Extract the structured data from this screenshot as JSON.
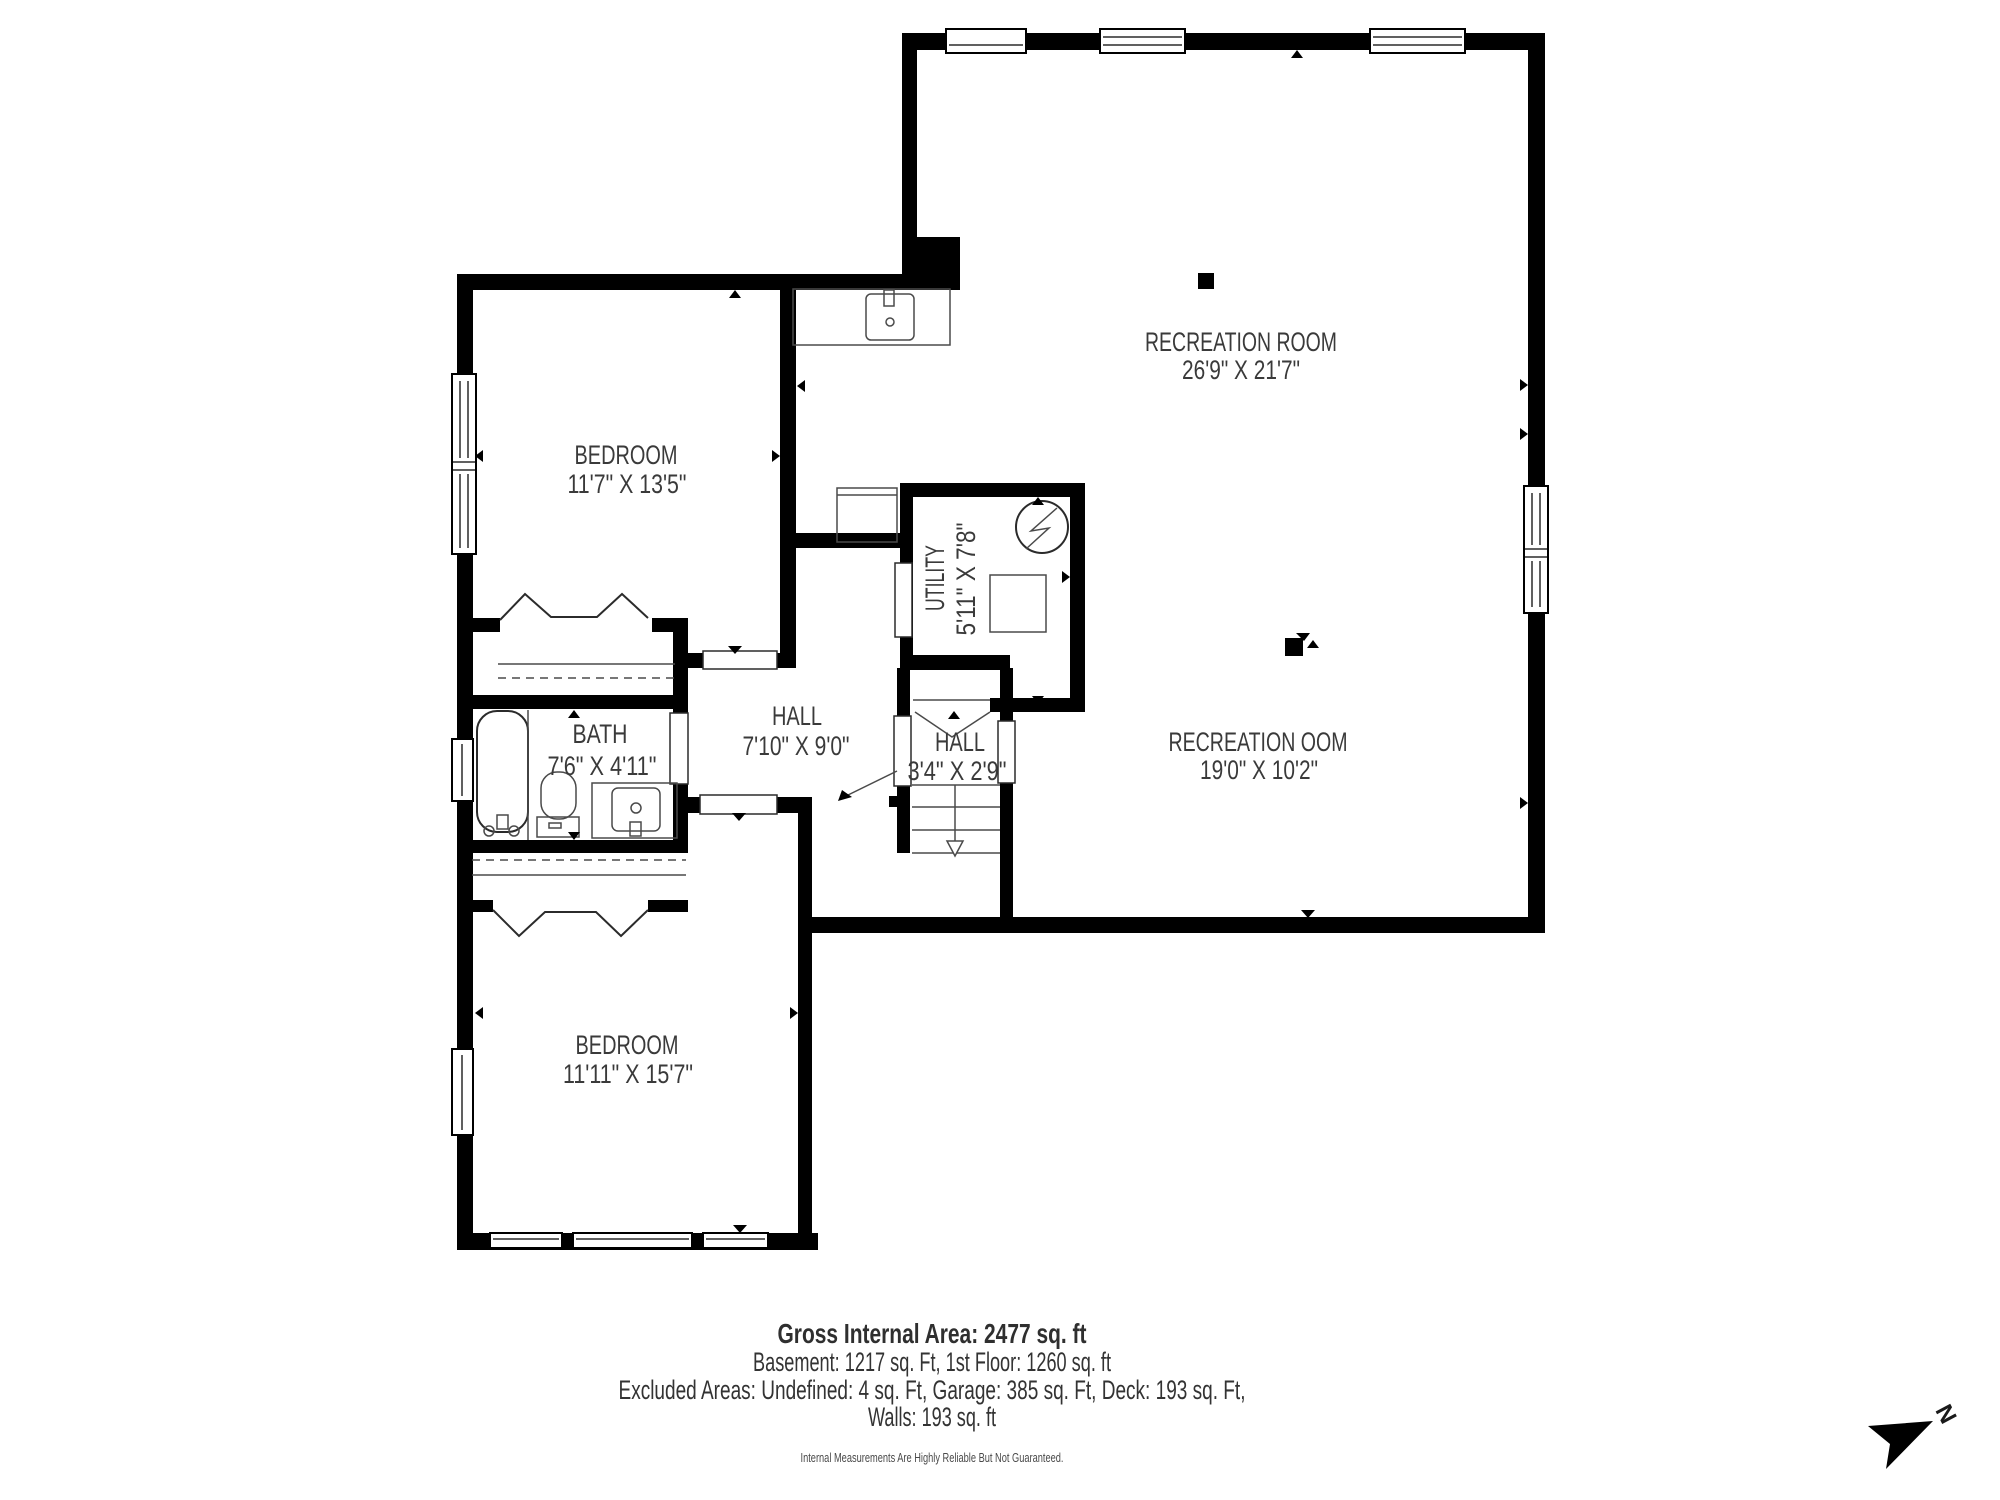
{
  "plan": {
    "rooms": {
      "recreation_upper": {
        "name": "RECREATION ROOM",
        "dims": "26'9\" X 21'7\""
      },
      "recreation_lower": {
        "name": "RECREATION OOM",
        "dims": "19'0\" X 10'2\""
      },
      "bedroom_upper": {
        "name": "BEDROOM",
        "dims": "11'7\" X 13'5\""
      },
      "bedroom_lower": {
        "name": "BEDROOM",
        "dims": "11'11\" X 15'7\""
      },
      "bath": {
        "name": "BATH",
        "dims": "7'6\" X 4'11\""
      },
      "hall_main": {
        "name": "HALL",
        "dims": "7'10\" X 9'0\""
      },
      "hall_small": {
        "name": "HALL",
        "dims": "3'4\" X 2'9\""
      },
      "utility": {
        "name": "UTILITY",
        "dims": "5'11\" X 7'8\""
      }
    }
  },
  "footer": {
    "gross_area": "Gross Internal Area: 2477 sq. ft",
    "areas_line1": "Basement: 1217 sq. Ft, 1st Floor: 1260 sq. ft",
    "areas_line2": "Excluded Areas: Undefined: 4 sq. Ft, Garage: 385 sq. Ft, Deck: 193 sq. Ft,",
    "areas_line3": "Walls: 193 sq. ft",
    "disclaimer": "Internal Measurements Are Highly Reliable But Not Guaranteed."
  },
  "compass": {
    "north_label": "N"
  },
  "colors": {
    "walls": "#000000",
    "label_text": "#3a3a3a",
    "fixture_lines": "#2b2b2b",
    "background": "#ffffff"
  },
  "icons": {
    "north_arrow": "northeast-pointer",
    "water_heater": "circle-with-bolt",
    "column_marker": "filled-square",
    "stairs": "treads-with-down-arrow"
  }
}
